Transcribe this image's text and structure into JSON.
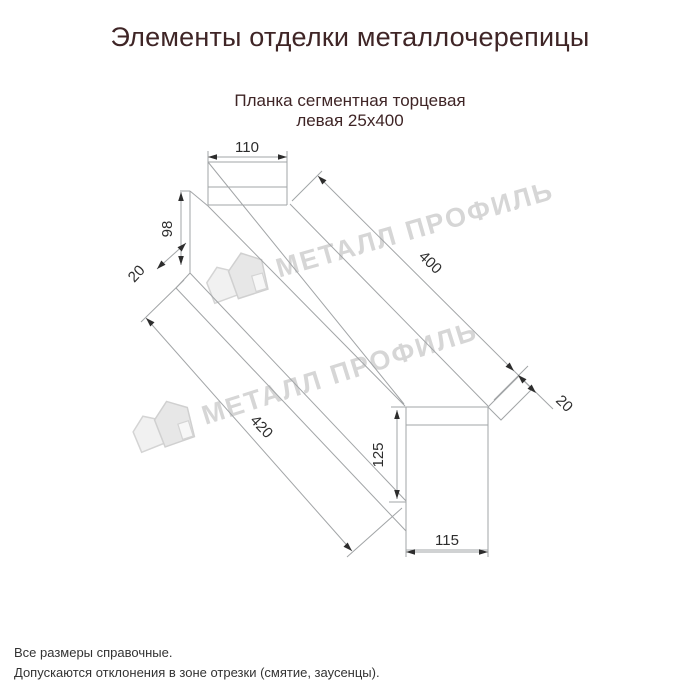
{
  "title": "Элементы отделки металлочерепицы",
  "subtitle": {
    "line1": "Планка сегментная торцевая",
    "line2": "левая 25х400"
  },
  "drawing": {
    "dims": {
      "top_width": "110",
      "neck_height": "98",
      "top_fold": "20",
      "top_edge_length": "400",
      "bottom_edge_length": "420",
      "end_face_height": "125",
      "end_face_width": "115",
      "end_fold": "20"
    },
    "watermark_text": "МЕТАЛЛ ПРОФИЛЬ"
  },
  "notes": {
    "line1": "Все размеры справочные.",
    "line2": "Допускаются отклонения в зоне отрезки (смятие, заусенцы)."
  },
  "colors": {
    "title_text": "#3f2526",
    "note_text": "#333333",
    "drawing_line": "#a2a5a7",
    "dimension_ink": "#2d2d2d",
    "watermark": "#d6d6d6"
  }
}
